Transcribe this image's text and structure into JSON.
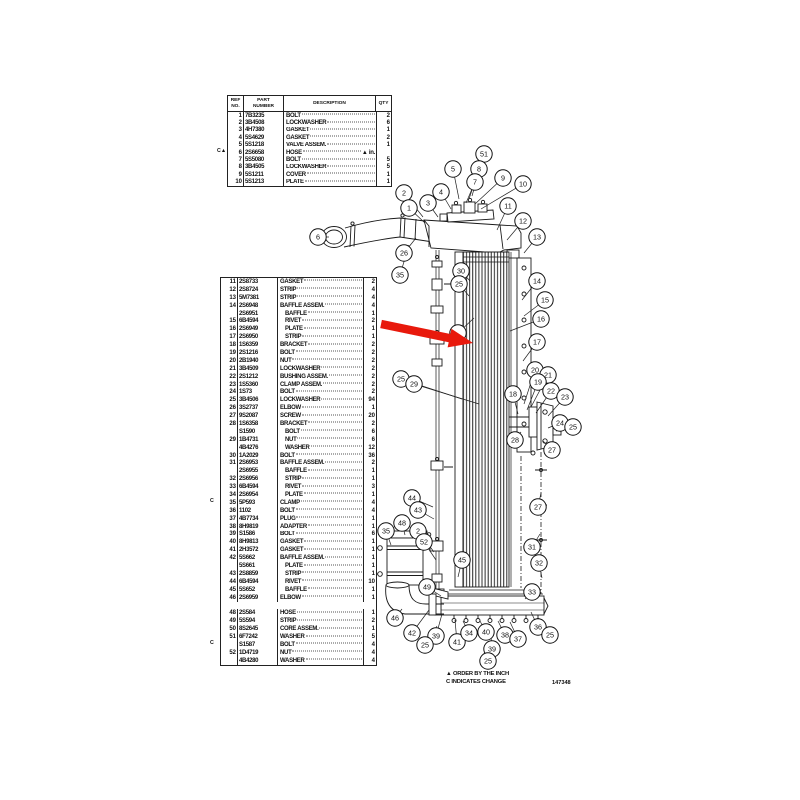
{
  "top_table": {
    "headers": {
      "ref": "REF\nNO.",
      "part": "PART\nNUMBER",
      "desc": "DESCRIPTION",
      "qty": "QTY"
    },
    "rows": [
      {
        "ref": "1",
        "part": "7B3235",
        "desc": "BOLT",
        "qty": "2"
      },
      {
        "ref": "2",
        "part": "3B4508",
        "desc": "LOCKWASHER",
        "qty": "6"
      },
      {
        "ref": "3",
        "part": "4H7380",
        "desc": "GASKET",
        "qty": "1"
      },
      {
        "ref": "4",
        "part": "5S4629",
        "desc": "GASKET",
        "qty": "2"
      },
      {
        "ref": "5",
        "part": "5S1218",
        "desc": "VALVE ASSEM.",
        "qty": "1"
      },
      {
        "ref": "6",
        "part": "2S6658",
        "desc": "HOSE",
        "qty": "",
        "m": "C▲",
        "suffix": "▲ in."
      },
      {
        "ref": "7",
        "part": "5S5080",
        "desc": "BOLT",
        "qty": "5"
      },
      {
        "ref": "8",
        "part": "3B4505",
        "desc": "LOCKWASHER",
        "qty": "5"
      },
      {
        "ref": "9",
        "part": "5S1211",
        "desc": "COVER",
        "qty": "1"
      },
      {
        "ref": "10",
        "part": "5S1213",
        "desc": "PLATE",
        "qty": "1"
      }
    ]
  },
  "left_table": {
    "rows": [
      {
        "ref": "11",
        "part": "2S8733",
        "desc": "GASKET",
        "qty": "2"
      },
      {
        "ref": "12",
        "part": "2S8724",
        "desc": "STRIP",
        "qty": "4"
      },
      {
        "ref": "13",
        "part": "5M7381",
        "desc": "STRIP",
        "qty": "4"
      },
      {
        "ref": "14",
        "part": "2S6948",
        "desc": "BAFFLE ASSEM.",
        "qty": "4"
      },
      {
        "ref": "",
        "part": "2S6951",
        "desc": "BAFFLE",
        "qty": "1",
        "ind": true
      },
      {
        "ref": "15",
        "part": "6B4594",
        "desc": "RIVET",
        "qty": "2",
        "ind": true
      },
      {
        "ref": "16",
        "part": "2S6949",
        "desc": "PLATE",
        "qty": "1",
        "ind": true
      },
      {
        "ref": "17",
        "part": "2S6950",
        "desc": "STRIP",
        "qty": "1",
        "ind": true
      },
      {
        "ref": "18",
        "part": "1S6359",
        "desc": "BRACKET",
        "qty": "2"
      },
      {
        "ref": "19",
        "part": "2S1216",
        "desc": "BOLT",
        "qty": "2"
      },
      {
        "ref": "20",
        "part": "2B1940",
        "desc": "NUT",
        "qty": "2"
      },
      {
        "ref": "21",
        "part": "3B4509",
        "desc": "LOCKWASHER",
        "qty": "2"
      },
      {
        "ref": "22",
        "part": "2S1212",
        "desc": "BUSHING ASSEM.",
        "qty": "2"
      },
      {
        "ref": "23",
        "part": "1S5360",
        "desc": "CLAMP ASSEM.",
        "qty": "2"
      },
      {
        "ref": "24",
        "part": "1S73",
        "desc": "BOLT",
        "qty": "2"
      },
      {
        "ref": "25",
        "part": "3B4506",
        "desc": "LOCKWASHER",
        "qty": "94"
      },
      {
        "ref": "26",
        "part": "3S2737",
        "desc": "ELBOW",
        "qty": "1"
      },
      {
        "ref": "27",
        "part": "9S2087",
        "desc": "SCREW",
        "qty": "20"
      },
      {
        "ref": "28",
        "part": "1S6358",
        "desc": "BRACKET",
        "qty": "2"
      },
      {
        "ref": "",
        "part": "S1590",
        "desc": "BOLT",
        "qty": "6",
        "ind": true
      },
      {
        "ref": "29",
        "part": "1B4731",
        "desc": "NUT",
        "qty": "6",
        "ind": true
      },
      {
        "ref": "",
        "part": "4B4276",
        "desc": "WASHER",
        "qty": "12",
        "ind": true
      },
      {
        "ref": "30",
        "part": "1A2029",
        "desc": "BOLT",
        "qty": "36"
      },
      {
        "ref": "31",
        "part": "2S6953",
        "desc": "BAFFLE ASSEM.",
        "qty": "2"
      },
      {
        "ref": "",
        "part": "2S6955",
        "desc": "BAFFLE",
        "qty": "1",
        "ind": true
      },
      {
        "ref": "32",
        "part": "2S6956",
        "desc": "STRIP",
        "qty": "1",
        "ind": true
      },
      {
        "ref": "33",
        "part": "6B4594",
        "desc": "RIVET",
        "qty": "3",
        "ind": true
      },
      {
        "ref": "34",
        "part": "2S6954",
        "desc": "PLATE",
        "qty": "1",
        "ind": true
      },
      {
        "ref": "35",
        "part": "5P593",
        "desc": "CLAMP",
        "qty": "4",
        "m": "C"
      },
      {
        "ref": "36",
        "part": "1102",
        "desc": "BOLT",
        "qty": "4"
      },
      {
        "ref": "37",
        "part": "4B7734",
        "desc": "PLUG",
        "qty": "1"
      },
      {
        "ref": "38",
        "part": "8H9819",
        "desc": "ADAPTER",
        "qty": "1"
      },
      {
        "ref": "39",
        "part": "S1586",
        "desc": "BOLT",
        "qty": "6"
      },
      {
        "ref": "40",
        "part": "8H9813",
        "desc": "GASKET",
        "qty": "1"
      },
      {
        "ref": "41",
        "part": "2H3572",
        "desc": "GASKET",
        "qty": "1"
      },
      {
        "ref": "42",
        "part": "5S662",
        "desc": "BAFFLE ASSEM.",
        "qty": "1"
      },
      {
        "ref": "",
        "part": "5S661",
        "desc": "PLATE",
        "qty": "1",
        "ind": true
      },
      {
        "ref": "43",
        "part": "2S8859",
        "desc": "STRIP",
        "qty": "1",
        "ind": true
      },
      {
        "ref": "44",
        "part": "6B4594",
        "desc": "RIVET",
        "qty": "10",
        "ind": true
      },
      {
        "ref": "45",
        "part": "5S652",
        "desc": "BAFFLE",
        "qty": "1",
        "ind": true
      },
      {
        "ref": "46",
        "part": "2S6959",
        "desc": "ELBOW",
        "qty": "1"
      },
      {
        "blank": true
      },
      {
        "ref": "48",
        "part": "2S584",
        "desc": "HOSE",
        "qty": "1"
      },
      {
        "ref": "49",
        "part": "5S594",
        "desc": "STRIP",
        "qty": "2"
      },
      {
        "ref": "50",
        "part": "8S2645",
        "desc": "CORE ASSEM.",
        "qty": "1"
      },
      {
        "ref": "51",
        "part": "6F7242",
        "desc": "WASHER",
        "qty": "5"
      },
      {
        "ref": "",
        "part": "S1587",
        "desc": "BOLT",
        "qty": "4",
        "m": "C"
      },
      {
        "ref": "52",
        "part": "1D4719",
        "desc": "NUT",
        "qty": "4"
      },
      {
        "ref": "",
        "part": "4B4280",
        "desc": "WASHER",
        "qty": "4"
      }
    ]
  },
  "drawing": {
    "arrow_color": "#e8190c",
    "callouts": [
      [
        "6",
        318,
        237,
        329,
        237
      ],
      [
        "2",
        404,
        193,
        423,
        217
      ],
      [
        "1",
        409,
        208,
        425,
        223
      ],
      [
        "3",
        428,
        203,
        438,
        217
      ],
      [
        "4",
        441,
        192,
        451,
        209
      ],
      [
        "5",
        453,
        169,
        459,
        199
      ],
      [
        "51",
        484,
        154,
        472,
        196
      ],
      [
        "8",
        479,
        169,
        469,
        199
      ],
      [
        "7",
        475,
        182,
        466,
        203
      ],
      [
        "9",
        503,
        178,
        475,
        204
      ],
      [
        "10",
        523,
        184,
        481,
        209
      ],
      [
        "11",
        508,
        206,
        497,
        230
      ],
      [
        "12",
        523,
        221,
        507,
        240
      ],
      [
        "13",
        537,
        237,
        524,
        253
      ],
      [
        "26",
        404,
        253,
        416,
        238
      ],
      [
        "35",
        400,
        275,
        409,
        245
      ],
      [
        "14",
        537,
        281,
        522,
        300
      ],
      [
        "15",
        545,
        300,
        524,
        316
      ],
      [
        "16",
        541,
        319,
        510,
        331
      ],
      [
        "17",
        537,
        342,
        523,
        361
      ],
      [
        "30",
        461,
        271,
        470,
        281
      ],
      [
        "25",
        459,
        284,
        469,
        296
      ],
      [
        "",
        458,
        333,
        474,
        318
      ],
      [
        "25",
        401,
        379,
        462,
        399
      ],
      [
        "29",
        414,
        384,
        479,
        404
      ],
      [
        "20",
        535,
        370,
        524,
        404
      ],
      [
        "21",
        548,
        375,
        531,
        407
      ],
      [
        "19",
        538,
        382,
        527,
        410
      ],
      [
        "22",
        551,
        391,
        536,
        413
      ],
      [
        "23",
        565,
        397,
        548,
        416
      ],
      [
        "18",
        513,
        394,
        518,
        414
      ],
      [
        "24",
        560,
        423,
        548,
        428
      ],
      [
        "25",
        573,
        427,
        556,
        431
      ],
      [
        "28",
        515,
        440,
        521,
        432
      ],
      [
        "27",
        552,
        450,
        543,
        441
      ],
      [
        "27",
        538,
        507,
        541,
        493
      ],
      [
        "31",
        532,
        547,
        540,
        534
      ],
      [
        "32",
        539,
        563,
        542,
        578
      ],
      [
        "33",
        532,
        592,
        525,
        599
      ],
      [
        "44",
        412,
        498,
        433,
        507
      ],
      [
        "43",
        418,
        510,
        434,
        519
      ],
      [
        "48",
        402,
        523,
        405,
        535
      ],
      [
        "35",
        386,
        531,
        391,
        545
      ],
      [
        "2",
        418,
        531,
        434,
        552
      ],
      [
        "52",
        424,
        542,
        436,
        560
      ],
      [
        "45",
        462,
        560,
        458,
        577
      ],
      [
        "49",
        427,
        587,
        441,
        596
      ],
      [
        "46",
        395,
        618,
        402,
        609
      ],
      [
        "42",
        412,
        633,
        429,
        610
      ],
      [
        "39",
        436,
        636,
        442,
        614
      ],
      [
        "25",
        425,
        645,
        437,
        626
      ],
      [
        "41",
        457,
        642,
        455,
        620
      ],
      [
        "34",
        469,
        633,
        463,
        621
      ],
      [
        "40",
        486,
        632,
        480,
        621
      ],
      [
        "38",
        505,
        635,
        498,
        621
      ],
      [
        "37",
        518,
        639,
        510,
        622
      ],
      [
        "36",
        538,
        627,
        531,
        612
      ],
      [
        "25",
        550,
        635,
        540,
        621
      ],
      [
        "39",
        492,
        649,
        490,
        625
      ],
      [
        "25",
        488,
        661,
        487,
        652
      ]
    ],
    "notes": [
      "▲ ORDER BY THE INCH",
      "C INDICATES CHANGE"
    ],
    "doc_number": "147348"
  }
}
